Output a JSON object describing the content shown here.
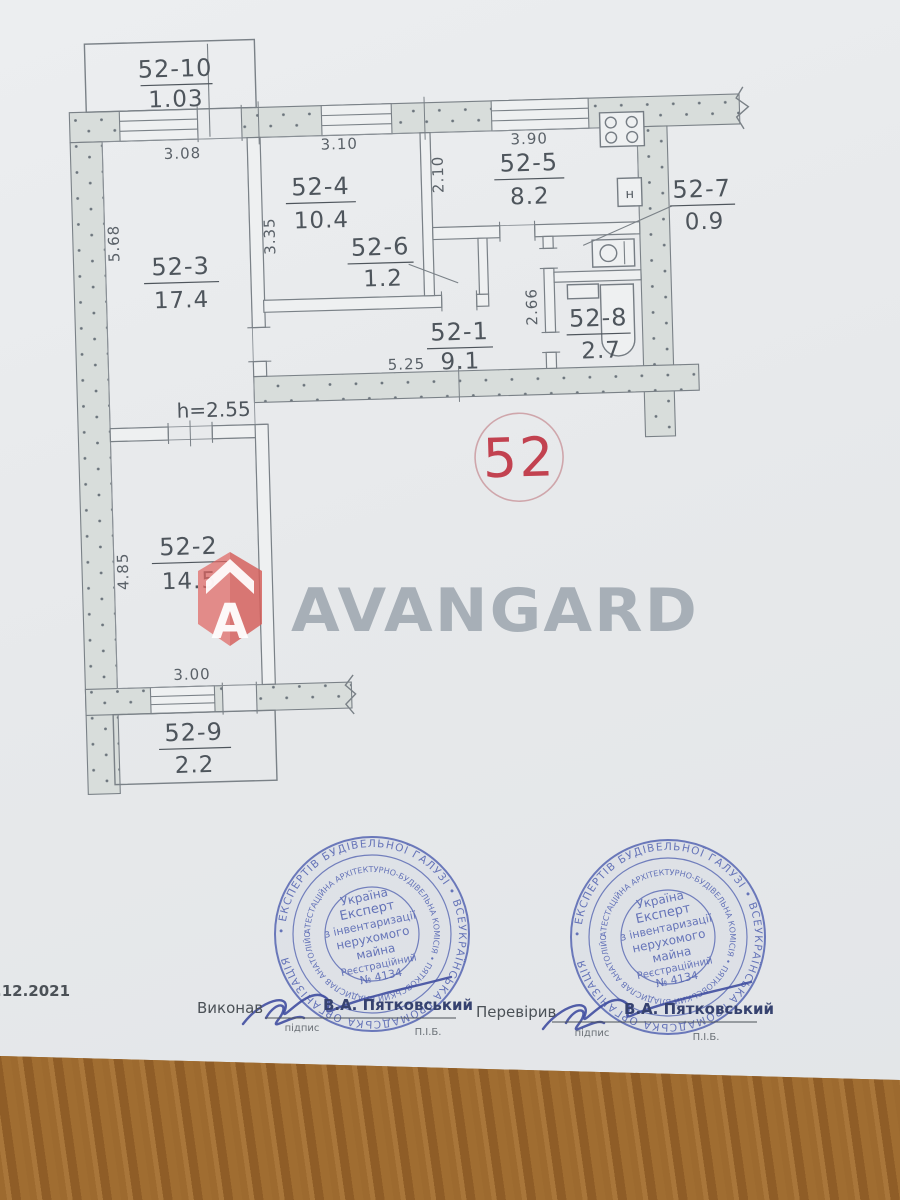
{
  "document": {
    "date": ".12.2021",
    "unit_number": "52",
    "height_note": "h=2.55"
  },
  "watermark": {
    "brand": "AVANGARD",
    "logo_letter": "A",
    "accent_color": "#e06663",
    "text_color": "#9fa8b0"
  },
  "plan": {
    "rooms": [
      {
        "id": "52-10",
        "area": "1.03"
      },
      {
        "id": "52-3",
        "area": "17.4"
      },
      {
        "id": "52-4",
        "area": "10.4"
      },
      {
        "id": "52-5",
        "area": "8.2"
      },
      {
        "id": "52-6",
        "area": "1.2"
      },
      {
        "id": "52-7",
        "area": "0.9"
      },
      {
        "id": "52-1",
        "area": "9.1"
      },
      {
        "id": "52-8",
        "area": "2.7"
      },
      {
        "id": "52-2",
        "area": "14.5"
      },
      {
        "id": "52-9",
        "area": "2.2"
      }
    ],
    "dimensions": {
      "top_52_3": "3.08",
      "top_52_4": "3.10",
      "top_52_5": "3.90",
      "left_52_3": "5.68",
      "left_52_4": "3.35",
      "left_52_5": "2.10",
      "san_height": "2.66",
      "corridor": "5.25",
      "left_52_2": "4.85",
      "bottom_52_2": "3.00"
    },
    "water_heater_label": "н"
  },
  "stamp": {
    "ring_outer": "• ЕКСПЕРТІВ БУДІВЕЛЬНОЇ ГАЛУЗІ • ВСЕУКРАЇНСЬКА ГРОМАДСЬКА ОРГАНІЗАЦІЯ ",
    "ring_inner": "АТЕСТАЦІЙНА АРХІТЕКТУРНО-БУДІВЕЛЬНА КОМІСІЯ • ПЯТКОВСЬКИЙ ВЛАДИСЛАВ АНАТОЛІЙОВИЧ ",
    "center_lines": [
      "Україна",
      "Експерт",
      "з інвентаризації",
      "нерухомого",
      "майна",
      "Реєстраційний",
      "№ 4134"
    ],
    "color": "#5565b2"
  },
  "signature_block": {
    "executed_label": "Виконав",
    "checked_label": "Перевірив",
    "name": "В.А. Пятковський",
    "signature_caption": "підпис",
    "name_caption": "П.І.Б."
  }
}
